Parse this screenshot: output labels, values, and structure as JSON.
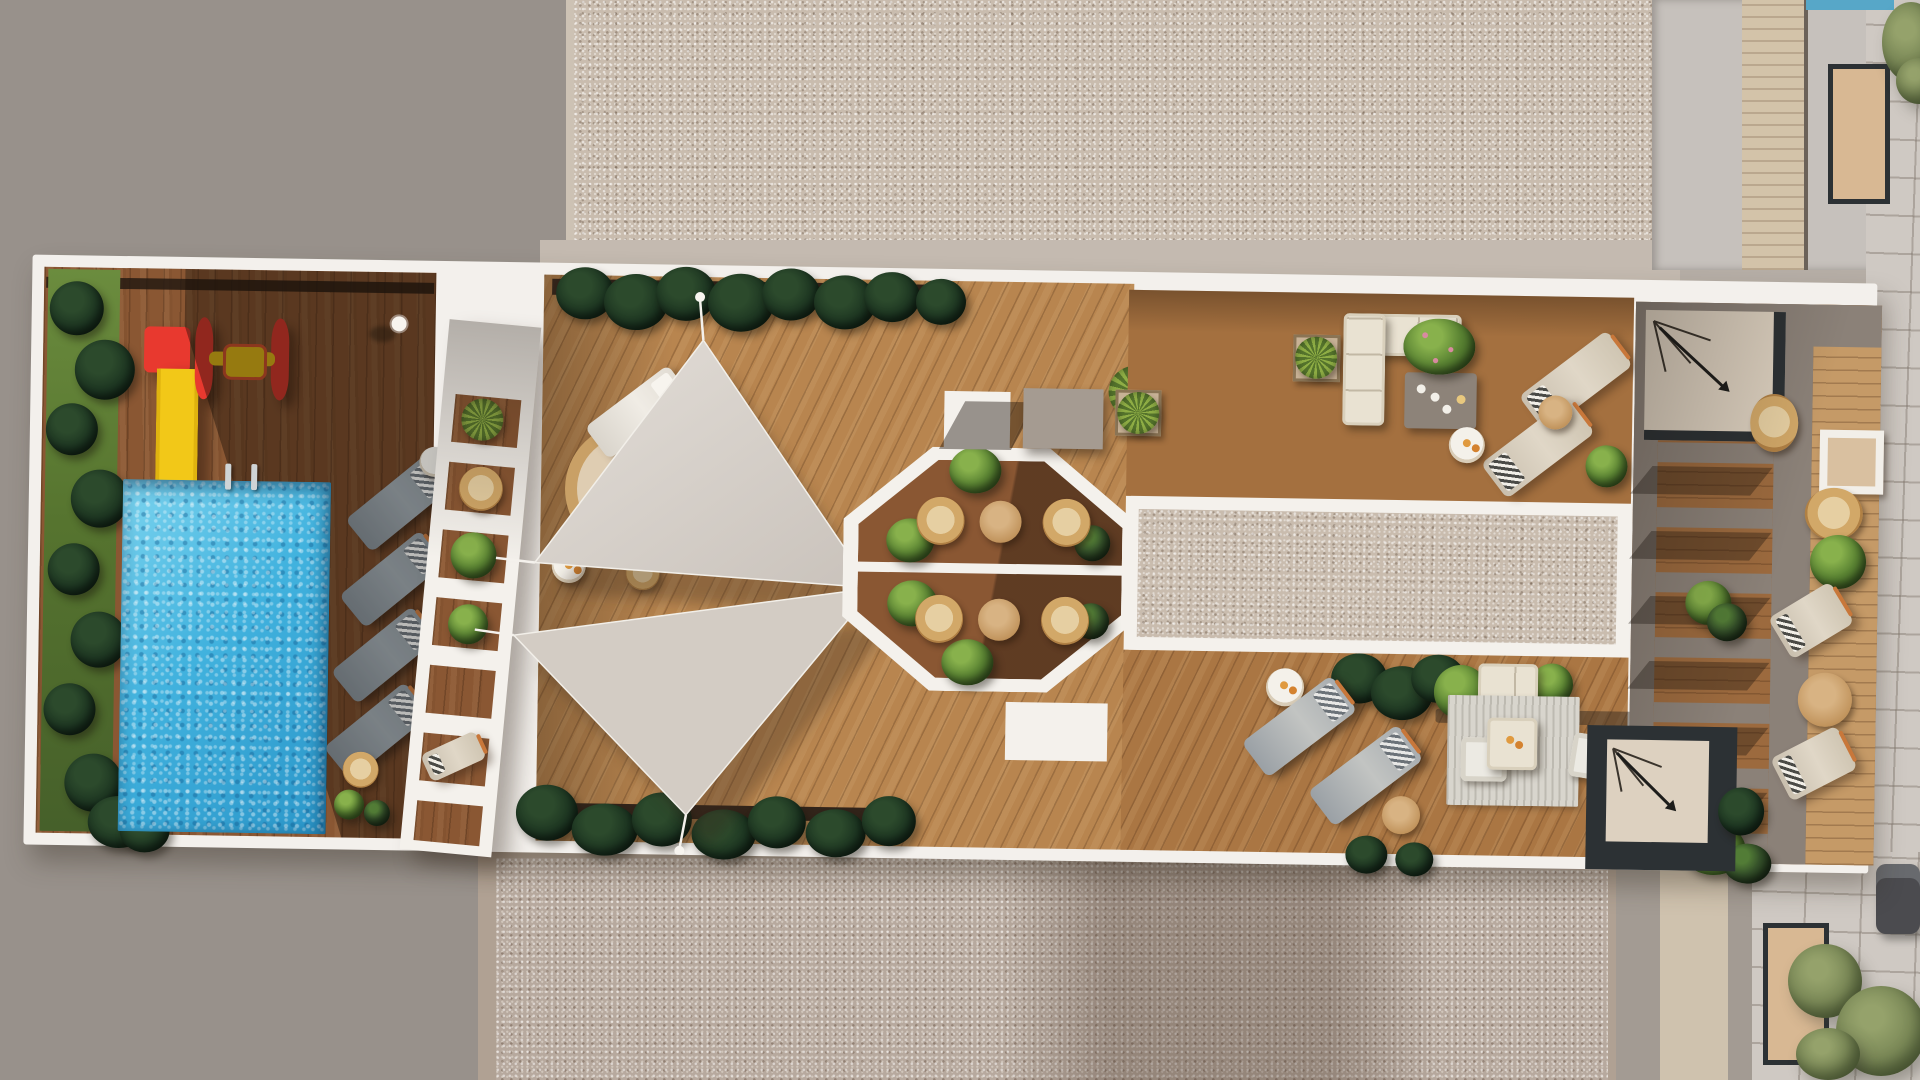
{
  "scene": {
    "description": "Aerial 3D architectural rendering of a rooftop amenity terrace with swimming pool, playground, shade sails, octagonal bistro nook, gravel strip, lounge decks and a slatted pergola, surrounded by concrete and gravel roofs",
    "areas": {
      "plaza": "Concrete roof plaza",
      "gravel_roof_top": "Gravel roof surface",
      "gravel_roof_bottom": "Gravel roof surface",
      "terrace": "Rooftop amenity terrace",
      "playground": "Children's playground with slide and spinner",
      "pool": "Swimming pool",
      "pool_deck": "Pool deck with sun loungers",
      "hedge": "Hedge planting strip",
      "divider": "White pergola divider with planters",
      "sail_deck": "Sun deck with triangular shade sails",
      "octagon": "Octagonal bistro seating nook",
      "gravel_strip": "Framed decorative gravel strip",
      "upper_lounge": "Corner lounge with sectional sofa",
      "sun_deck": "Sunbathing loungers",
      "living_room": "Outdoor living room on rug",
      "pergola": "Slatted pergola chill-out terrace",
      "stairs_top": "Roof access stair",
      "stairs_bottom": "Stairwell",
      "path": "Access path",
      "street": "Neighbouring street with tree and parked car",
      "neighbour_roof": "Neighbouring building roof"
    }
  },
  "palette": {
    "concrete": "#b6aea6",
    "concrete_dark": "#98918b",
    "gravel_top": "#c9bcae",
    "gravel_bottom": "#b7a99e",
    "taupe_border": "#b0a193",
    "stone": "#cfc9c3",
    "path_gray": "#a39b93",
    "path_light": "#cfc2ae",
    "terrace_white": "#f3f0ec",
    "wood_dark": "#8a5733",
    "wood_mid": "#a4703f",
    "wood_light": "#b8854f",
    "pool_blue": "#41b2de",
    "pool_deep": "#2b96c9",
    "grass": "#56742f",
    "sail": "#dbd5ce",
    "slide_red": "#e8392f",
    "slide_yellow": "#f2c818",
    "lounger_gray": "#8b949a",
    "cream": "#e9e2d2",
    "rattan": "#d2a868",
    "table_wood": "#c2955e",
    "pergola_taupe": "#8b8178",
    "frame_dark": "#2c3134",
    "stairs_beige": "#ddd1c0",
    "rug": "#d8d5cd",
    "orange": "#c8773a",
    "car_gray": "#4b4b4f",
    "tree_olive": "#7c8a58",
    "skylight_tan": "#d8b893",
    "plank_tan": "#d3c3a9",
    "ctable": "#8d8379"
  }
}
